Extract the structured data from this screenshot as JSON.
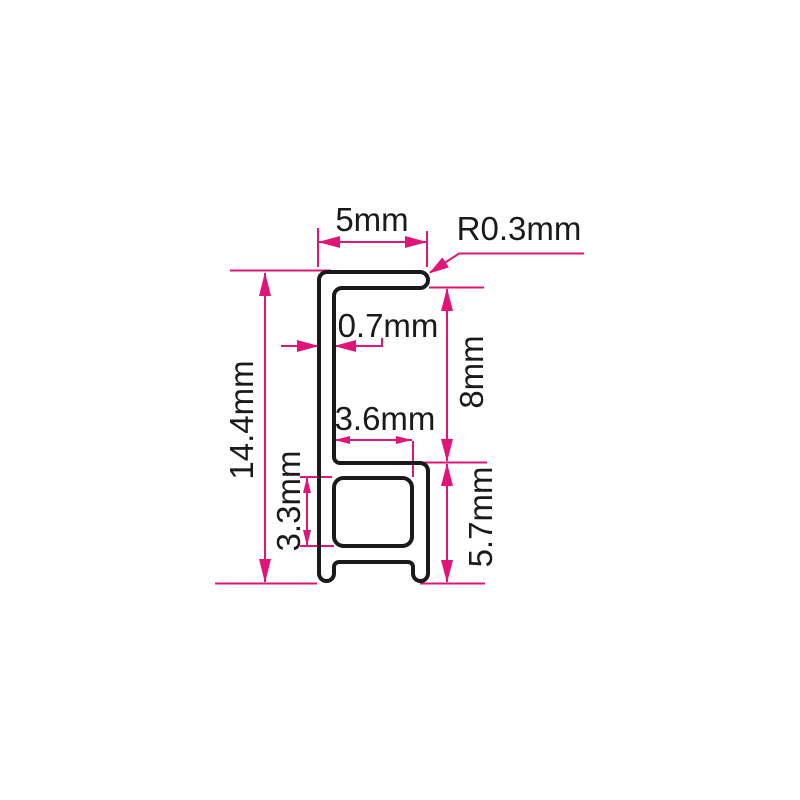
{
  "drawing": {
    "title": "aluminium profile cross-section with dimensions",
    "unit": "mm",
    "labels": {
      "top_width": "5mm",
      "corner_radius": "R0.3mm",
      "wall_thickness": "0.7mm",
      "upper_height": "8mm",
      "slot_width": "3.6mm",
      "total_height": "14.4mm",
      "cavity_height": "3.3mm",
      "lower_height": "5.7mm"
    },
    "dimensions": [
      {
        "name": "top flange width",
        "value": 5,
        "unit": "mm"
      },
      {
        "name": "corner radius",
        "value": 0.3,
        "unit": "mm"
      },
      {
        "name": "wall thickness",
        "value": 0.7,
        "unit": "mm"
      },
      {
        "name": "upper section height",
        "value": 8,
        "unit": "mm"
      },
      {
        "name": "inner slot width",
        "value": 3.6,
        "unit": "mm"
      },
      {
        "name": "total height",
        "value": 14.4,
        "unit": "mm"
      },
      {
        "name": "cavity height",
        "value": 3.3,
        "unit": "mm"
      },
      {
        "name": "lower section height",
        "value": 5.7,
        "unit": "mm"
      }
    ],
    "colors": {
      "dimension_lines": "#e1147a",
      "profile_outline": "#1a1a1a",
      "background": "#ffffff"
    }
  }
}
